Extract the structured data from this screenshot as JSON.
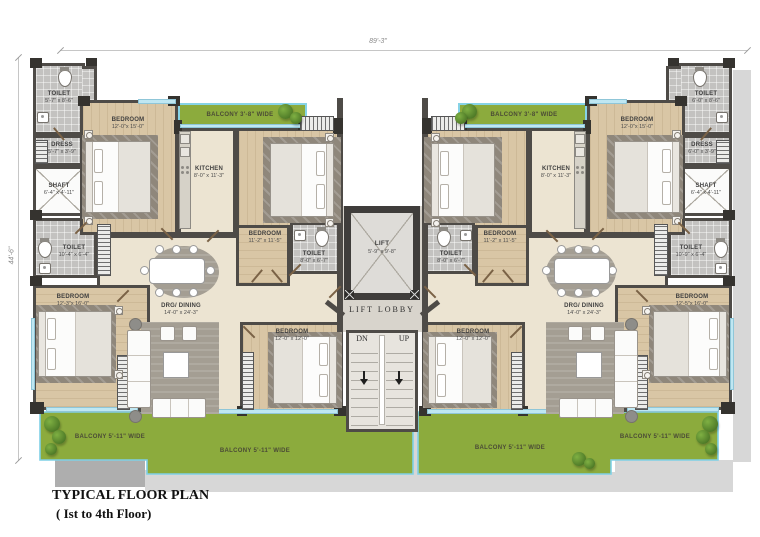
{
  "title": {
    "line1": "TYPICAL FLOOR PLAN",
    "line2": "( Ist to 4th Floor)"
  },
  "dimensions": {
    "overall_width": "89'-3\"",
    "overall_height": "44'-6\""
  },
  "core": {
    "lift_name": "LIFT",
    "lift_dims": "5'-9\" x 9'-8\"",
    "lobby": "LIFT LOBBY",
    "down": "DN",
    "up": "UP"
  },
  "left_unit": {
    "toilet_top": {
      "name": "TOILET",
      "dims": "5'-7\" x 8'-6\""
    },
    "dress": {
      "name": "DRESS",
      "dims": "5'-7\" x 3'-9\""
    },
    "shaft": {
      "name": "SHAFT",
      "dims": "6'-4\" x 4'-11\""
    },
    "toilet_mid": {
      "name": "TOILET",
      "dims": "10'-4\" x 6'-4\""
    },
    "bedroom_top": {
      "name": "BEDROOM",
      "dims": "12'-0\"x 15'-0\""
    },
    "kitchen": {
      "name": "KITCHEN",
      "dims": "8'-0\" x 11'-3\""
    },
    "bedroom_mid": {
      "name": "BEDROOM",
      "dims": "11'-2\" x 11'-5\""
    },
    "toilet_inner": {
      "name": "TOILET",
      "dims": "8'-0\" x 6'-7\""
    },
    "balcony_top": "BALCONY 3'-8\" WIDE",
    "living": {
      "name": "DRG/ DINING",
      "dims": "14'-0\" x 24'-3\""
    },
    "bedroom_bottom": {
      "name": "BEDROOM",
      "dims": "12'-3\"x 16'-0\""
    },
    "bedroom_center": {
      "name": "BEDROOM",
      "dims": "12'-0\" x 12'-0\""
    },
    "balcony_bottom_outer": "BALCONY 5'-11\" WIDE",
    "balcony_bottom_inner": "BALCONY 5'-11\" WIDE"
  },
  "right_unit": {
    "toilet_top": {
      "name": "TOILET",
      "dims": "6'-0\" x 8'-6\""
    },
    "dress": {
      "name": "DRESS",
      "dims": "6'-0\" x 3'-9\""
    },
    "shaft": {
      "name": "SHAFT",
      "dims": "6'-4\" x 4'-11\""
    },
    "toilet_mid": {
      "name": "TOILET",
      "dims": "10'-9\" x 6'-4\""
    },
    "bedroom_top": {
      "name": "BEDROOM",
      "dims": "12'-0\"x 15'-0\""
    },
    "kitchen": {
      "name": "KITCHEN",
      "dims": "8'-0\" x 11'-3\""
    },
    "bedroom_mid": {
      "name": "BEDROOM",
      "dims": "11'-2\" x 11'-5\""
    },
    "toilet_inner": {
      "name": "TOILET",
      "dims": "8'-0\" x 6'-7\""
    },
    "balcony_top": "BALCONY 3'-8\" WIDE",
    "living": {
      "name": "DRG/ DINING",
      "dims": "14'-0\" x 24'-3\""
    },
    "bedroom_bottom": {
      "name": "BEDROOM",
      "dims": "12'-5\"x 16'-0\""
    },
    "bedroom_center": {
      "name": "BEDROOM",
      "dims": "12'-0\" x 12'-0\""
    },
    "balcony_bottom_outer": "BALCONY 5'-11\" WIDE",
    "balcony_bottom_inner": "BALCONY 5'-11\" WIDE"
  }
}
